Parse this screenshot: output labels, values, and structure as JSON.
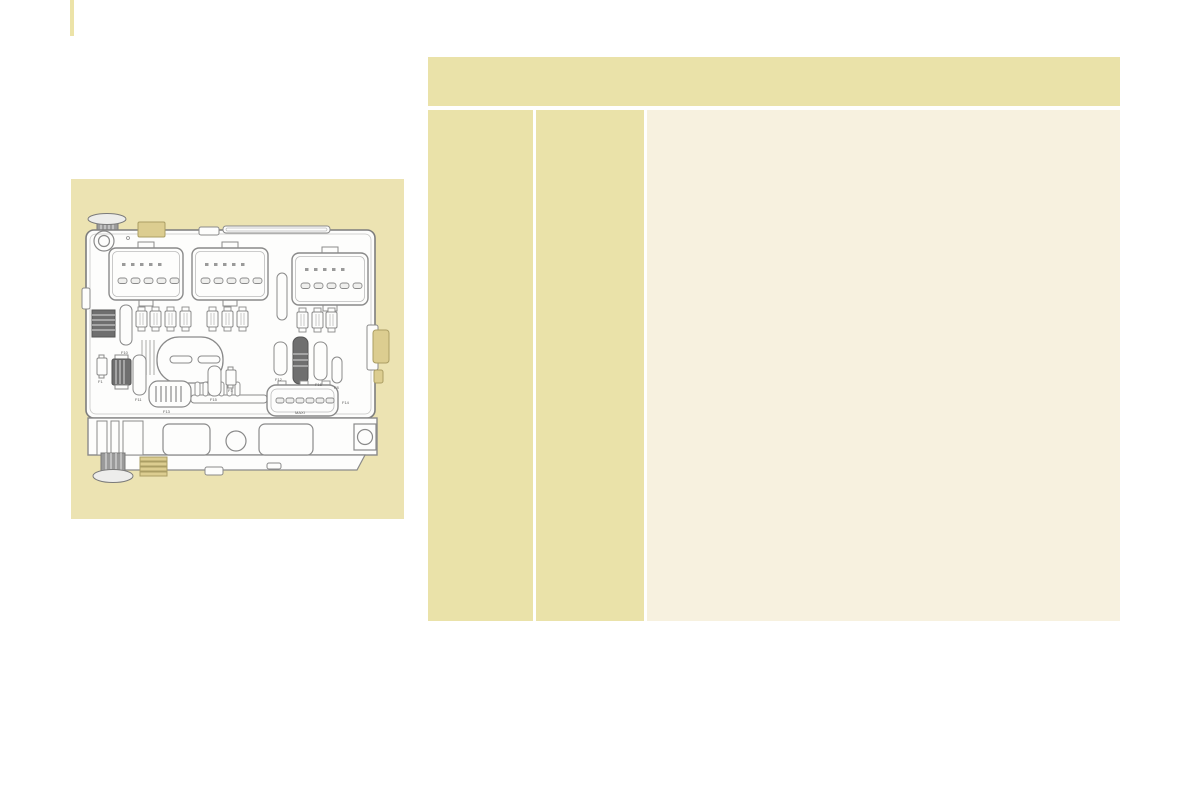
{
  "page": {
    "background": "#ffffff"
  },
  "accent_bar": {
    "color": "#ece3a8"
  },
  "figure": {
    "panel_bg": "#ece3b2",
    "diagram_name": "engine-compartment-fusebox-diagram",
    "diagram": {
      "stroke_color": "#8a8a8a",
      "inner_stroke_color": "#bcbcbc",
      "dark_fill": "#6f6f6f",
      "tab_fill": "#dccd90",
      "tab_stroke": "#ab9e64",
      "box_fill": "#fdfdfc",
      "labels": [
        {
          "text": "F10",
          "x": 50,
          "y": 175
        },
        {
          "text": "F1",
          "x": 27,
          "y": 204
        },
        {
          "text": "F11",
          "x": 64,
          "y": 222
        },
        {
          "text": "F13",
          "x": 92,
          "y": 234
        },
        {
          "text": "F15",
          "x": 139,
          "y": 222
        },
        {
          "text": "F3",
          "x": 157,
          "y": 213
        },
        {
          "text": "F12",
          "x": 204,
          "y": 202
        },
        {
          "text": "F16",
          "x": 244,
          "y": 207
        },
        {
          "text": "F8",
          "x": 263,
          "y": 210
        },
        {
          "text": "F14",
          "x": 271,
          "y": 225
        },
        {
          "text": "MAXI",
          "x": 224,
          "y": 235
        }
      ]
    }
  },
  "table": {
    "header": {
      "bg": "#eae2a9",
      "label": ""
    },
    "columns": [
      {
        "name": "column-1",
        "bg": "#eae2a9",
        "text": ""
      },
      {
        "name": "column-2",
        "bg": "#eae2a9",
        "text": ""
      },
      {
        "name": "column-3",
        "bg": "#f7f1df",
        "text": ""
      }
    ]
  }
}
